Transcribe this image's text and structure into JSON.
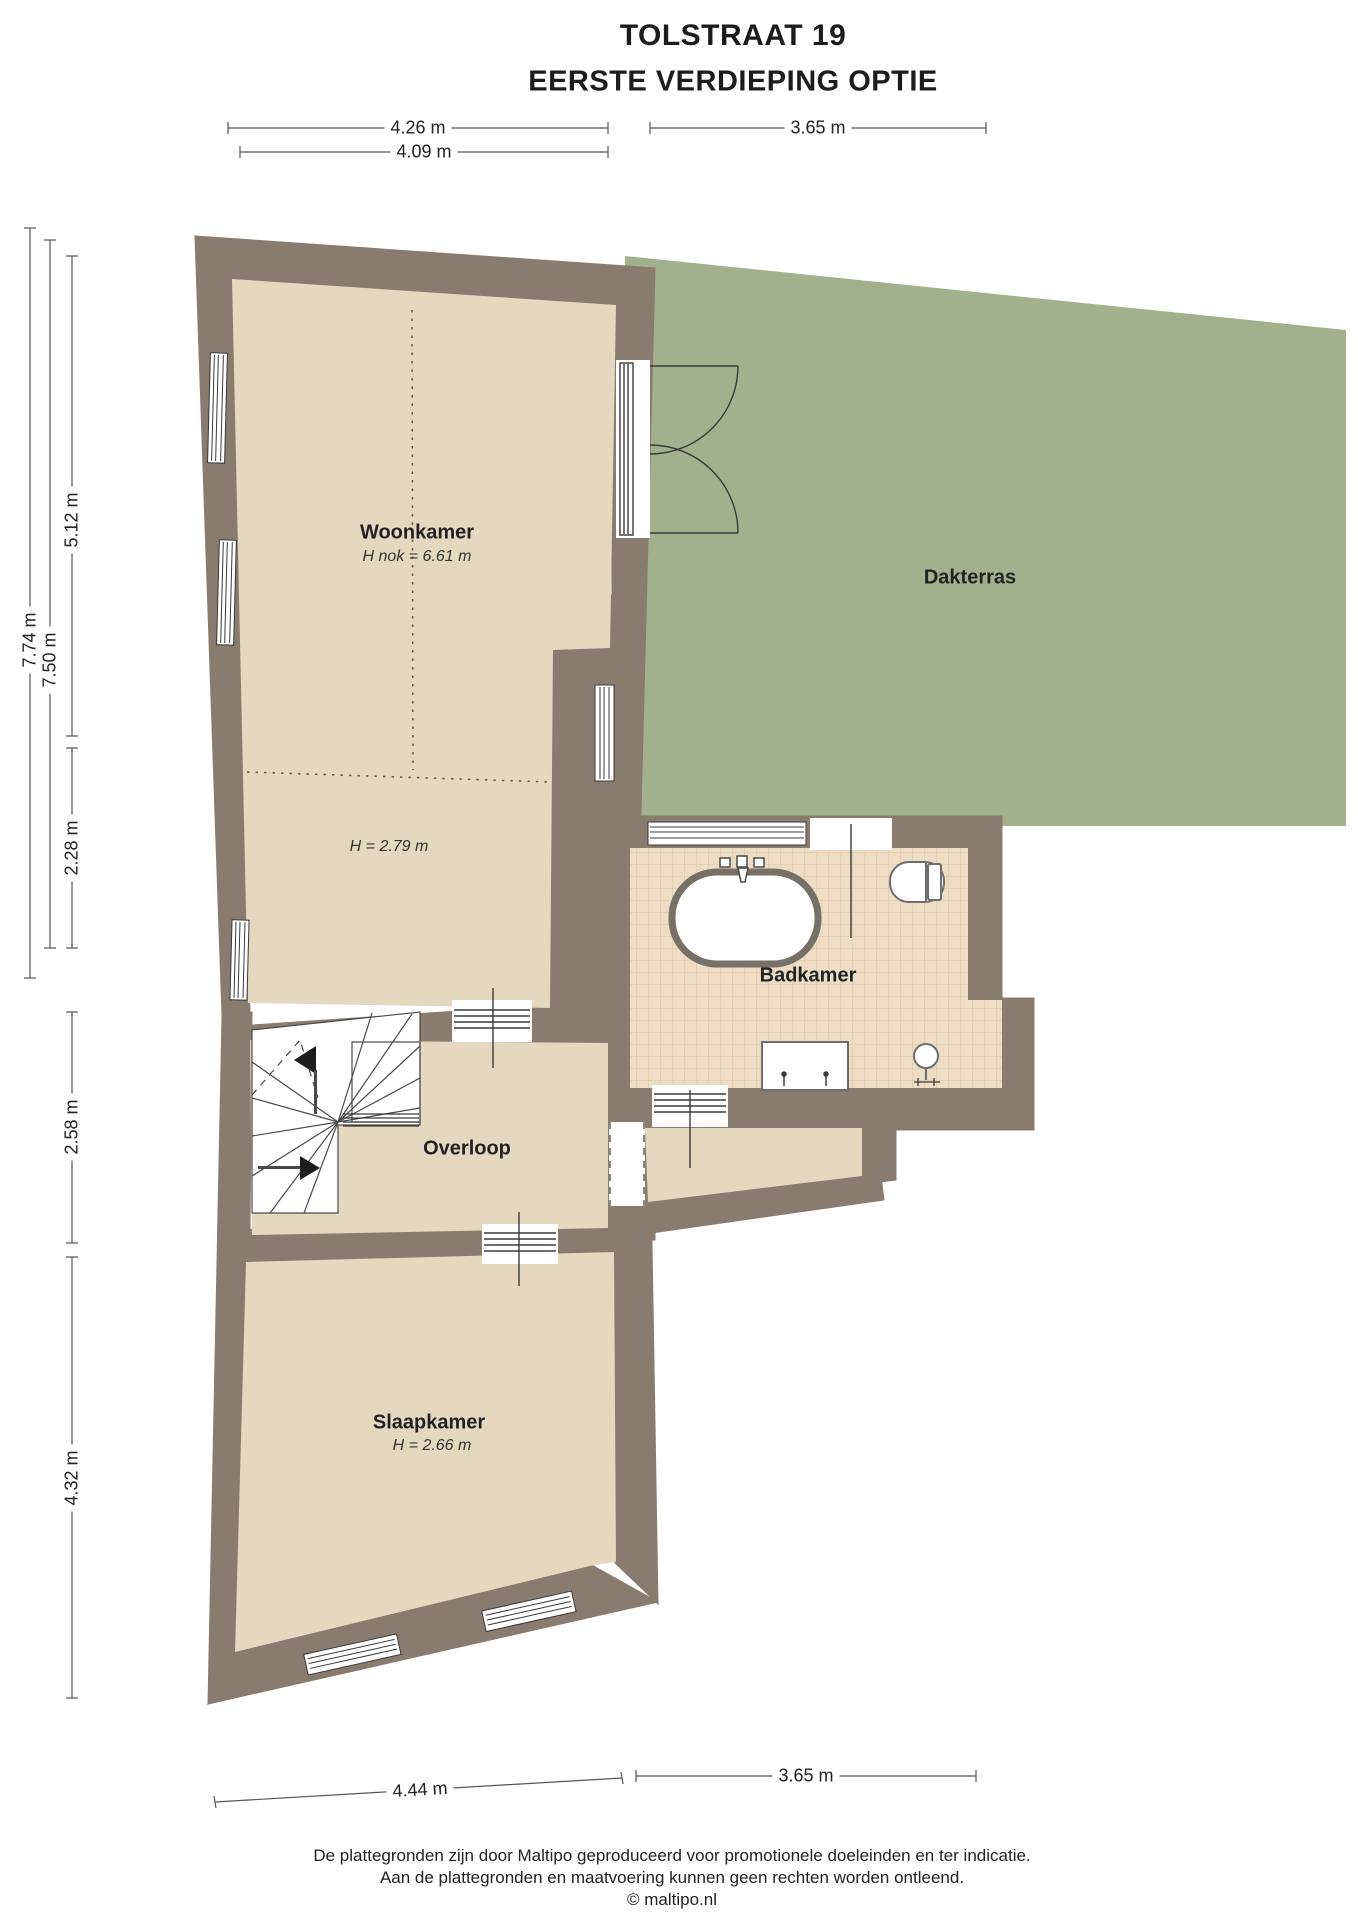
{
  "title": {
    "line1": "TOLSTRAAT 19",
    "line2": "EERSTE VERDIEPING OPTIE"
  },
  "rooms": {
    "woonkamer": {
      "name": "Woonkamer",
      "height_note": "H nok = 6.61 m",
      "height_note_low": "H = 2.79 m"
    },
    "dakterras": {
      "name": "Dakterras"
    },
    "badkamer": {
      "name": "Badkamer"
    },
    "overloop": {
      "name": "Overloop"
    },
    "slaapkamer": {
      "name": "Slaapkamer",
      "height_note": "H = 2.66 m"
    }
  },
  "dimensions": {
    "top": [
      {
        "label": "4.26 m"
      },
      {
        "label": "4.09 m"
      },
      {
        "label": "3.65 m"
      }
    ],
    "left": [
      {
        "label": "7.74 m"
      },
      {
        "label": "7.50 m"
      },
      {
        "label": "5.12 m"
      },
      {
        "label": "2.28 m"
      },
      {
        "label": "2.58 m"
      },
      {
        "label": "4.32 m"
      }
    ],
    "bottom": [
      {
        "label": "4.44 m"
      },
      {
        "label": "3.65 m"
      }
    ]
  },
  "footer": {
    "line1": "De plattegronden zijn door Maltipo geproduceerd voor promotionele doeleinden en ter indicatie.",
    "line2": "Aan de plattegronden en maatvoering kunnen geen rechten worden ontleend.",
    "line3": "© maltipo.nl"
  },
  "colors": {
    "wall": "#897b6e",
    "floor": "#e6d7c1",
    "tile": "#eedcc4",
    "tile_grid": "#d8c2a4",
    "terrace": "#a3b08d",
    "symbol_stroke": "#6e6e6e",
    "line": "#3a3a3a",
    "dim": "#555555"
  }
}
